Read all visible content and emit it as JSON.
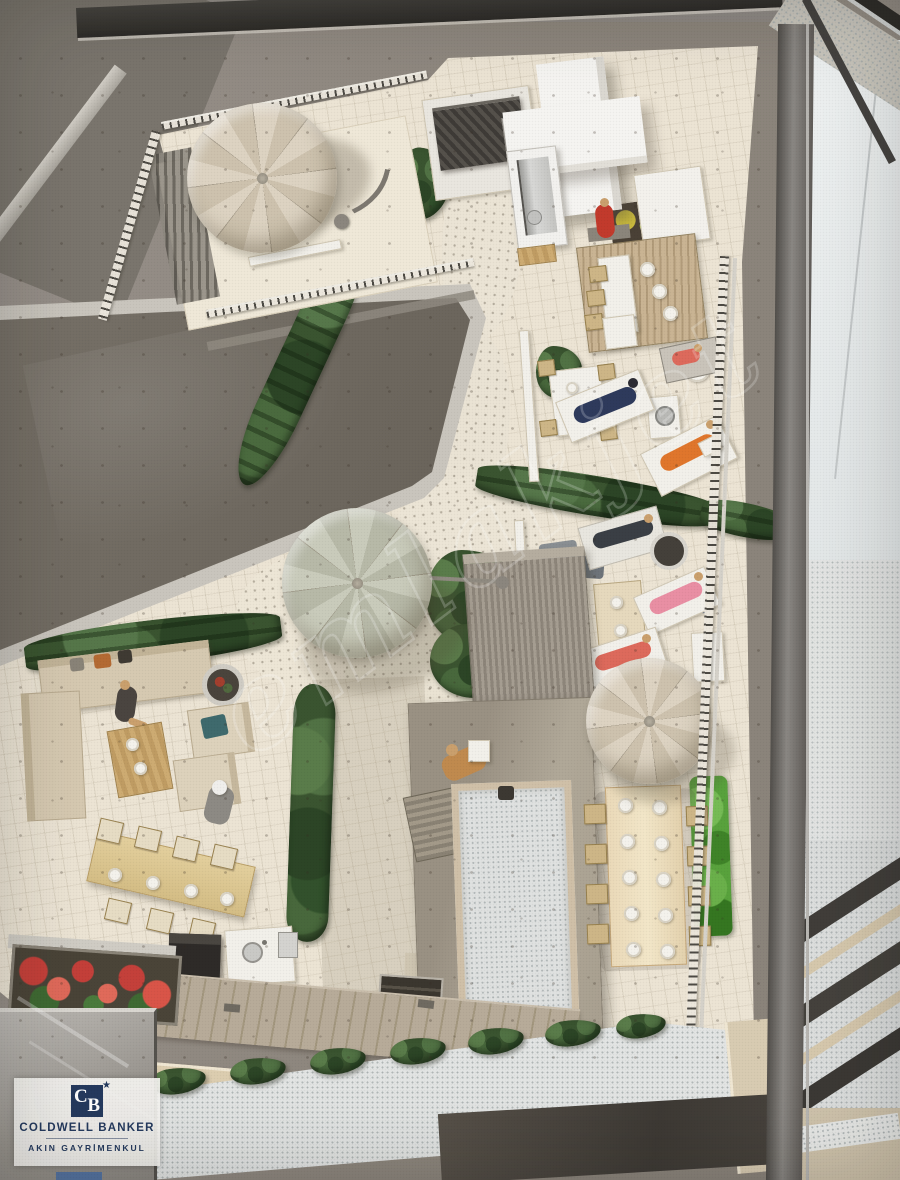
{
  "scene": {
    "subject": "top-down photo of an architectural rooftop-terrace scale model displayed in a glass case",
    "elements": [
      "roof terraces",
      "parasols",
      "cypress hedges",
      "miniature figures",
      "elevator cores",
      "dining sets",
      "planters",
      "glass display case"
    ]
  },
  "watermark": {
    "text": "emlakjet"
  },
  "logo": {
    "monogram_c": "C",
    "monogram_b": "B",
    "star": "★",
    "brand": "COLDWELL BANKER",
    "subtitle": "AKIN GAYRİMENKUL"
  },
  "palette": {
    "board": "#948d85",
    "board_dark": "#7a756d",
    "cream": "#ece4d4",
    "cream_light": "#f2ecdd",
    "paving": "#d8d0bf",
    "deck": "#b2a593",
    "parapet": "#dccdb0",
    "roof_white": "#e2e4e3",
    "skylight": "#6f6a61",
    "frame_silver": "#c9c5bd",
    "case_bar": "#5a5753",
    "window_light": "#edf0f1",
    "hedge": "#3a5430",
    "hedge_light": "#5a7c4a",
    "grass_wall": "#58a23c",
    "flower_red": "#c4403a",
    "flower_yellow": "#cdbd3e",
    "umb_a": "#ddd3c2",
    "umb_b": "#cdc2ae",
    "umb2_a": "#c9cbbb",
    "umb2_b": "#b7b9a8",
    "wood": "#c9ab72",
    "wood_light": "#ead9b8",
    "navy_logo": "#253a5e",
    "figure_green": "#96b53e",
    "figure_red": "#c23a2c",
    "figure_navy": "#2e3a5c",
    "figure_orange": "#e0762c",
    "figure_pink": "#e98fa4",
    "figure_salmon": "#dd6a5c",
    "teal": "#3f6a6d",
    "denim": "#5c6f8e",
    "tan_skin": "#caa06d"
  }
}
